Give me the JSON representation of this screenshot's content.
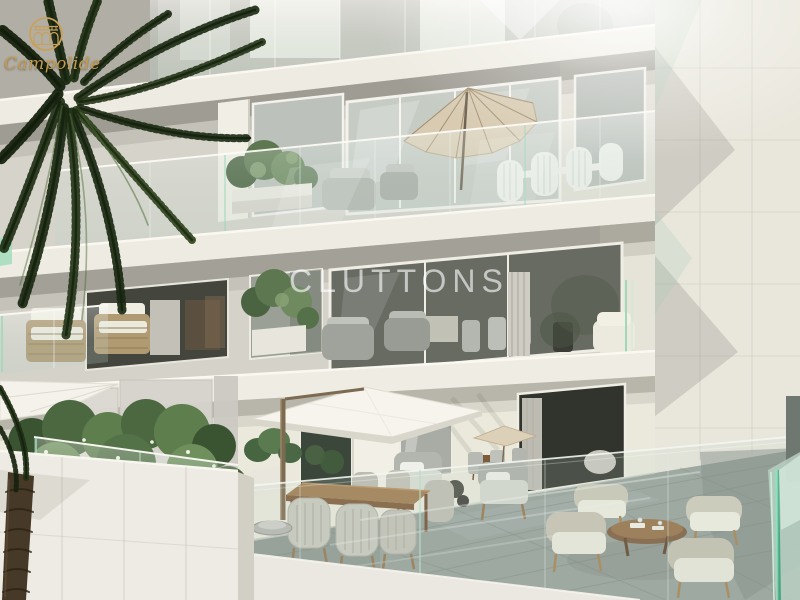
{
  "title": "Campolide residential development – exterior CGI render",
  "branding": {
    "developer_logo": {
      "text": "Campolide",
      "emblem": "aqueduct-arches-in-gold-circle",
      "color": "#c79a4e"
    },
    "agency_watermark": {
      "text": "CLUTTONS",
      "color": "#ffffff",
      "opacity": 0.62
    }
  },
  "palette": {
    "facade": "#d6d3ca",
    "slab": "#eeece2",
    "right_wall": "#e9e7dc",
    "terrace_floor": "#96a09a",
    "glass_tint": "#cfe0d8",
    "glass_edge_green": "#8fd6b2",
    "teal_glass_corner": "#7fd4ae",
    "palm_green": "#1f2f15",
    "beige_parasol": "#d8cbb2",
    "white_parasol": "#f6f4ed",
    "wood": "#8a6038",
    "wicker": "#b09a72",
    "cushion_white": "#efede2"
  },
  "scene": {
    "building": {
      "levels_visible": 4,
      "style": "modern beige stone facade with frameless glass balcony balustrades"
    },
    "objects": [
      {
        "name": "palm-tree",
        "desc": "dark green palm fronds and trunk in left foreground"
      },
      {
        "name": "balcony-parasol",
        "desc": "beige tilted parasol on 2nd-level balcony"
      },
      {
        "name": "terrace-parasol",
        "desc": "large white square cantilever parasol on ground terrace"
      },
      {
        "name": "dining-set",
        "desc": "wooden dining table with woven grey chairs"
      },
      {
        "name": "coffee-lounge-set",
        "desc": "four wicker armchairs around round wooden coffee table"
      },
      {
        "name": "rattan-lounge-chairs",
        "desc": "rattan armchairs with white cushions on 3rd-level balcony"
      },
      {
        "name": "planters",
        "desc": "white planters with green shrubs and flowers"
      },
      {
        "name": "privacy-screens",
        "desc": "frosted glass privacy screens on lower terrace"
      },
      {
        "name": "glass-balustrades",
        "desc": "green-edged frameless glass railings on every level"
      }
    ]
  }
}
